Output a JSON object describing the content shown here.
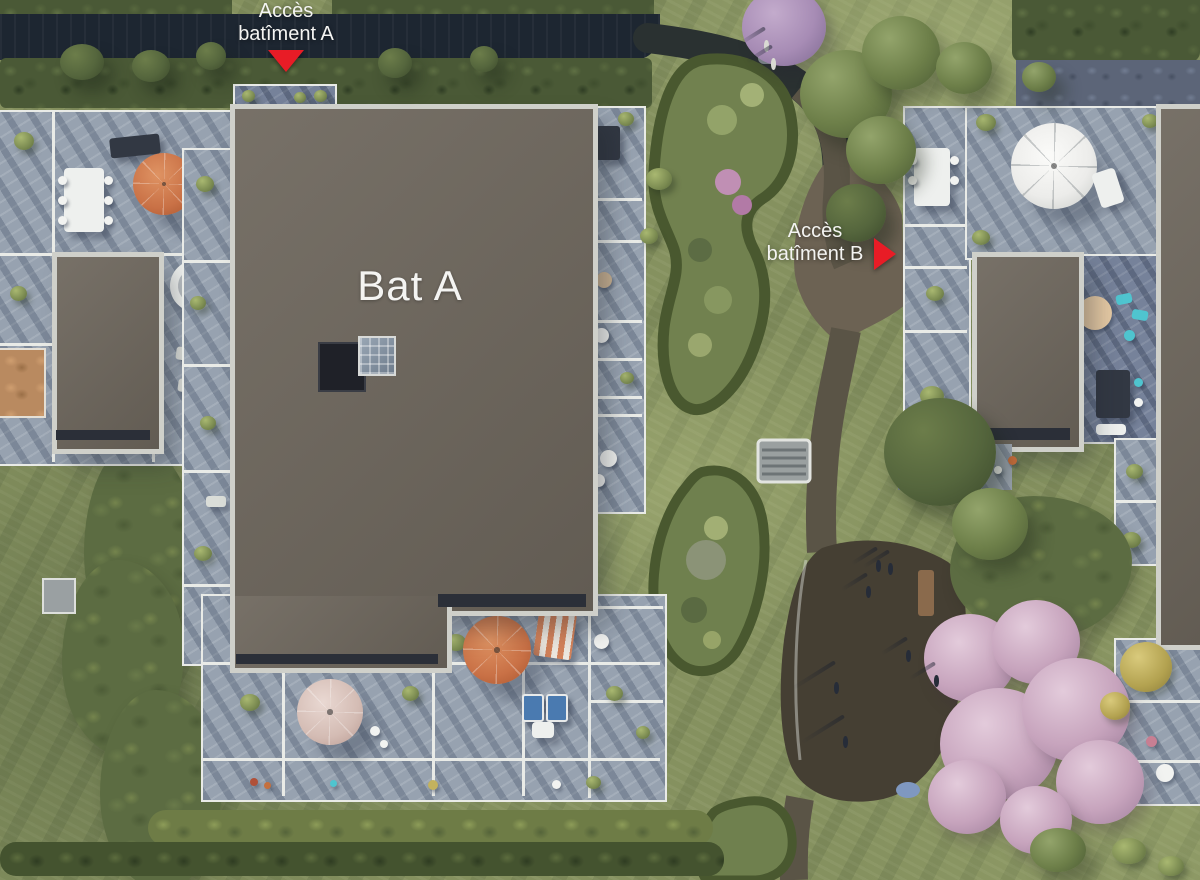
{
  "scene": {
    "labels": {
      "access_a": {
        "line1": "Accès",
        "line2": "batîment A"
      },
      "access_b": {
        "line1": "Accès",
        "line2": "batîment B"
      },
      "building_a": "Bat A"
    },
    "colors": {
      "lawn": "#85915f",
      "hedge": "#4a5936",
      "canal": "#1d2631",
      "path": "#5a5446",
      "path_dark": "#2a3131",
      "plaza": "#6c6253",
      "playground": "#453f33",
      "roof": "#6d665c",
      "roof_edge": "#cfd0ca",
      "roof_dark_band": "#2b2f38",
      "terrace": "#97a2b0",
      "terrace_dark": "#76829a",
      "frame": "#e9ebe7",
      "marker_red": "#e81c26",
      "label_white": "#f4f4f2",
      "umbrella_orange": "#c97146",
      "umbrella_pink": "#d4bcb4",
      "umbrella_white": "#ececea",
      "furniture_blue": "#4a7ab0",
      "pool_teal": "#4fc4cf",
      "blossom": "#c7a4bd",
      "lilac": "#a78cb5",
      "gold": "#b3a250"
    }
  }
}
